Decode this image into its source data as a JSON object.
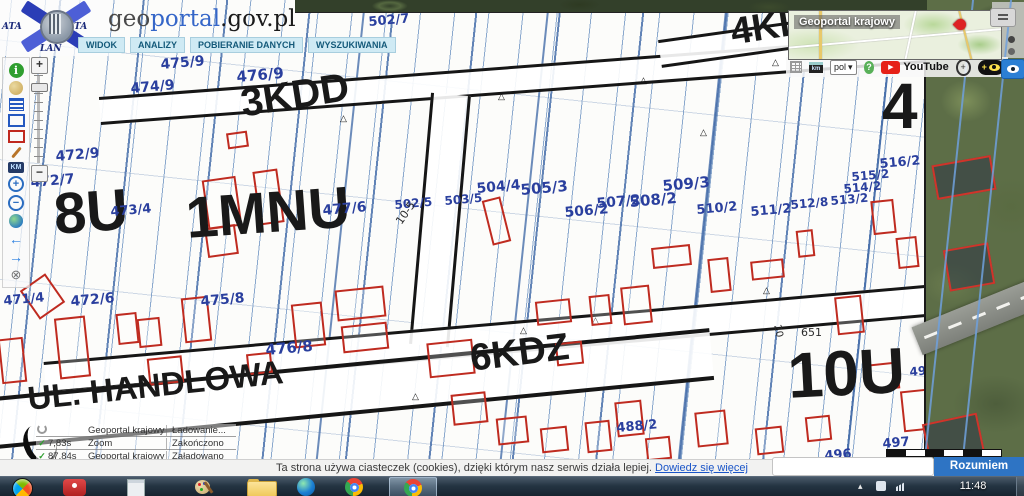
{
  "header": {
    "logo": {
      "geo": "geo",
      "portal": "portal",
      "suffix": ".gov.pl",
      "mark_top_left": "ATA",
      "mark_top_right": "TA",
      "mark_bottom": "LAN"
    },
    "tabs": [
      {
        "label": "WIDOK"
      },
      {
        "label": "ANALIZY"
      },
      {
        "label": "POBIERANIE DANYCH"
      },
      {
        "label": "WYSZUKIWANIA"
      }
    ]
  },
  "minimap": {
    "title": "Geoportal krajowy"
  },
  "topbar": {
    "language": "pol",
    "youtube": "YouTube",
    "km_label": "km",
    "help_glyph": "?"
  },
  "toolbar": {
    "items": [
      {
        "name": "info",
        "glyph": "i"
      },
      {
        "name": "legend",
        "glyph": ""
      },
      {
        "name": "layers",
        "glyph": ""
      },
      {
        "name": "select-blue",
        "glyph": ""
      },
      {
        "name": "select-red",
        "glyph": ""
      },
      {
        "name": "draw",
        "glyph": ""
      },
      {
        "name": "measure",
        "glyph": "KM"
      },
      {
        "name": "zoom-in",
        "glyph": "+"
      },
      {
        "name": "zoom-out",
        "glyph": "−"
      },
      {
        "name": "globe",
        "glyph": ""
      },
      {
        "name": "back",
        "glyph": "←"
      },
      {
        "name": "forward",
        "glyph": "→"
      },
      {
        "name": "close",
        "glyph": "⊗"
      }
    ]
  },
  "map": {
    "zone_labels": [
      {
        "text": "8U",
        "x": 52,
        "y": 186,
        "size": 58,
        "rot": -4
      },
      {
        "text": "1MNU",
        "x": 184,
        "y": 190,
        "size": 58,
        "rot": -4
      },
      {
        "text": "3KDD",
        "x": 238,
        "y": 84,
        "size": 40,
        "rot": -9
      },
      {
        "text": "6KDZ",
        "x": 468,
        "y": 340,
        "size": 38,
        "rot": -7
      },
      {
        "text": "4KL",
        "x": 728,
        "y": 14,
        "size": 38,
        "rot": -9
      },
      {
        "text": "4",
        "x": 882,
        "y": 74,
        "size": 64,
        "rot": 0
      },
      {
        "text": "10U",
        "x": 786,
        "y": 344,
        "size": 64,
        "rot": -3
      },
      {
        "text": "UL. HANDLOWA",
        "x": 26,
        "y": 382,
        "size": 33,
        "rot": -6
      }
    ],
    "parcel_labels": [
      {
        "text": "502/7",
        "x": 368,
        "y": 16,
        "size": 13,
        "rot": -5
      },
      {
        "text": "475/9",
        "x": 160,
        "y": 58,
        "size": 14,
        "rot": -5
      },
      {
        "text": "474/9",
        "x": 130,
        "y": 82,
        "size": 14,
        "rot": -5
      },
      {
        "text": "476/9",
        "x": 236,
        "y": 70,
        "size": 15,
        "rot": -5
      },
      {
        "text": "472/9",
        "x": 55,
        "y": 150,
        "size": 14,
        "rot": -5
      },
      {
        "text": "472/7",
        "x": 30,
        "y": 176,
        "size": 14,
        "rot": -5
      },
      {
        "text": "473/4",
        "x": 110,
        "y": 206,
        "size": 13,
        "rot": -5
      },
      {
        "text": "477/6",
        "x": 322,
        "y": 204,
        "size": 14,
        "rot": -5
      },
      {
        "text": "502/5",
        "x": 394,
        "y": 199,
        "size": 12,
        "rot": -5
      },
      {
        "text": "503/5",
        "x": 444,
        "y": 195,
        "size": 12,
        "rot": -5
      },
      {
        "text": "504/4",
        "x": 476,
        "y": 182,
        "size": 14,
        "rot": -5
      },
      {
        "text": "505/3",
        "x": 520,
        "y": 183,
        "size": 15,
        "rot": -5
      },
      {
        "text": "506/2",
        "x": 564,
        "y": 206,
        "size": 14,
        "rot": -5
      },
      {
        "text": "507/2",
        "x": 596,
        "y": 197,
        "size": 14,
        "rot": -5
      },
      {
        "text": "508/2",
        "x": 629,
        "y": 195,
        "size": 15,
        "rot": -5
      },
      {
        "text": "509/3",
        "x": 662,
        "y": 179,
        "size": 15,
        "rot": -5
      },
      {
        "text": "510/2",
        "x": 696,
        "y": 204,
        "size": 13,
        "rot": -5
      },
      {
        "text": "511/2",
        "x": 750,
        "y": 206,
        "size": 13,
        "rot": -5
      },
      {
        "text": "512/8",
        "x": 790,
        "y": 199,
        "size": 12,
        "rot": -5
      },
      {
        "text": "513/2",
        "x": 830,
        "y": 195,
        "size": 12,
        "rot": -5
      },
      {
        "text": "514/2",
        "x": 843,
        "y": 183,
        "size": 12,
        "rot": -5
      },
      {
        "text": "515/2",
        "x": 851,
        "y": 171,
        "size": 12,
        "rot": -5
      },
      {
        "text": "516/2",
        "x": 879,
        "y": 158,
        "size": 13,
        "rot": -5
      },
      {
        "text": "472/6",
        "x": 70,
        "y": 295,
        "size": 14,
        "rot": -5
      },
      {
        "text": "471/4",
        "x": 3,
        "y": 295,
        "size": 13,
        "rot": -5
      },
      {
        "text": "475/8",
        "x": 200,
        "y": 295,
        "size": 14,
        "rot": -5
      },
      {
        "text": "476/8",
        "x": 265,
        "y": 343,
        "size": 15,
        "rot": -5
      },
      {
        "text": "488/2",
        "x": 616,
        "y": 422,
        "size": 13,
        "rot": -5
      },
      {
        "text": "495",
        "x": 909,
        "y": 366,
        "size": 12,
        "rot": -5
      },
      {
        "text": "497",
        "x": 882,
        "y": 438,
        "size": 13,
        "rot": -5
      },
      {
        "text": "496",
        "x": 824,
        "y": 450,
        "size": 13,
        "rot": -5
      }
    ],
    "annotations": [
      {
        "text": "10-5",
        "x": 394,
        "y": 220,
        "size": 11,
        "rot": -55
      },
      {
        "text": "20",
        "x": 781,
        "y": 324,
        "size": 10,
        "rot": 78
      },
      {
        "text": "651",
        "x": 801,
        "y": 327,
        "size": 11,
        "rot": 0
      }
    ]
  },
  "status": {
    "rows": [
      {
        "icon": "spinner",
        "time": "",
        "source": "Geoportal krajowy",
        "message": "Ładowanie..."
      },
      {
        "icon": "check",
        "time": "7,83s",
        "source": "Zoom",
        "message": "Zakończono"
      },
      {
        "icon": "check",
        "time": "87,84s",
        "source": "Geoportal krajowy",
        "message": "Załadowano"
      }
    ]
  },
  "cookiebar": {
    "text": "Ta strona używa ciasteczek (cookies), dzięki którym nasz serwis działa lepiej. ",
    "link": "Dowiedz się więcej",
    "button": "Rozumiem"
  },
  "taskbar": {
    "clock": "11:48"
  },
  "colors": {
    "parcel_label": "#2a3f9e",
    "building_outline": "#bf2b20",
    "map_line": "#6f9fc9",
    "road_outline": "#151515",
    "accent_blue": "#2e74c4",
    "youtube_red": "#e62117"
  }
}
